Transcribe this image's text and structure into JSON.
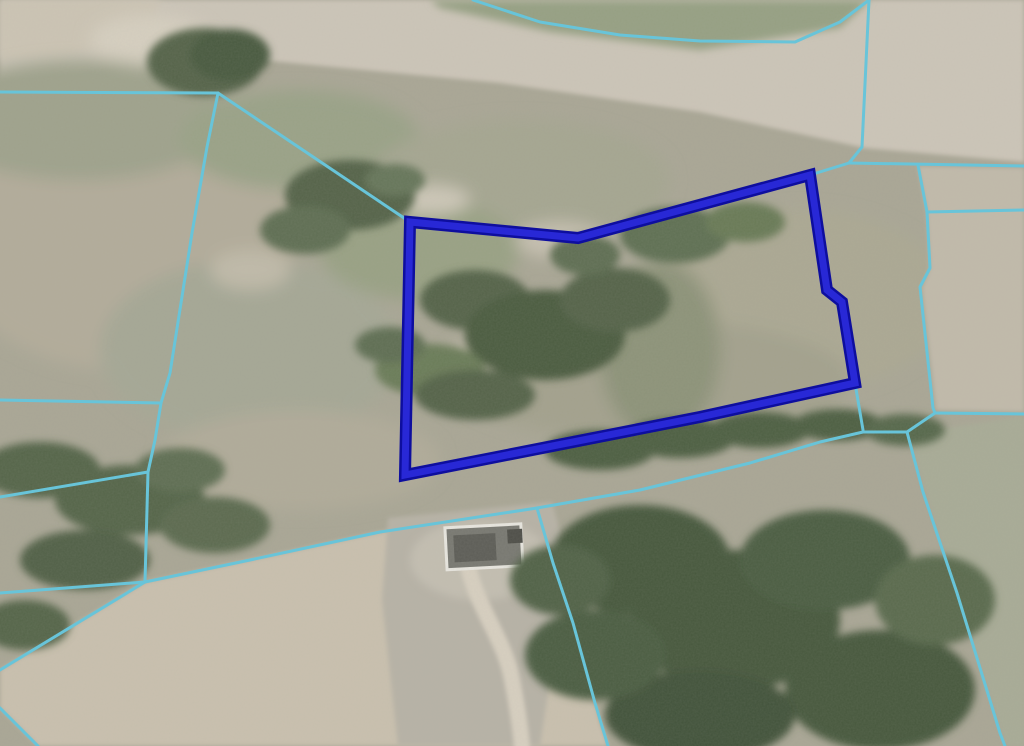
{
  "map": {
    "kind": "aerial-parcel-map",
    "palette": {
      "field_base": "#a9a695",
      "road": "#ccc5b8",
      "dirt_tan": "#c9c0ae",
      "concrete_pad": "#b7b2a6",
      "tree_dark": "#47583d",
      "tree_mid": "#54644a",
      "tree_light": "#6b7b59",
      "right_field_tan": "#c1baaa",
      "bottom_right_field": "#a8ab96",
      "driveway": "#d7cfc0"
    },
    "selected_parcel": {
      "label": "selected-parcel",
      "outline_color": "#2828d6",
      "outline_rim_color": "#0e0e9e",
      "outline_width": 7,
      "rim_width": 12,
      "points": [
        [
          410,
          222
        ],
        [
          578,
          238
        ],
        [
          810,
          175
        ],
        [
          827,
          290
        ],
        [
          842,
          302
        ],
        [
          855,
          383
        ],
        [
          700,
          417
        ],
        [
          405,
          475
        ]
      ]
    },
    "boundary_lines": {
      "color": "#68c4d9",
      "width": 3,
      "polylines": [
        [
          [
            0,
            92
          ],
          [
            218,
            93
          ]
        ],
        [
          [
            218,
            93
          ],
          [
            410,
            222
          ]
        ],
        [
          [
            218,
            93
          ],
          [
            207,
            147
          ],
          [
            192,
            233
          ],
          [
            170,
            373
          ],
          [
            161,
            403
          ],
          [
            155,
            440
          ],
          [
            148,
            472
          ],
          [
            145,
            582
          ]
        ],
        [
          [
            0,
            400
          ],
          [
            161,
            403
          ]
        ],
        [
          [
            0,
            497
          ],
          [
            148,
            472
          ]
        ],
        [
          [
            0,
            593
          ],
          [
            145,
            582
          ]
        ],
        [
          [
            145,
            582
          ],
          [
            0,
            670
          ]
        ],
        [
          [
            145,
            582
          ],
          [
            250,
            560
          ],
          [
            380,
            532
          ],
          [
            537,
            508
          ],
          [
            640,
            490
          ],
          [
            750,
            463
          ],
          [
            820,
            442
          ],
          [
            863,
            432
          ],
          [
            907,
            432
          ]
        ],
        [
          [
            537,
            508
          ],
          [
            553,
            563
          ],
          [
            573,
            623
          ],
          [
            595,
            703
          ],
          [
            608,
            746
          ]
        ],
        [
          [
            0,
            708
          ],
          [
            38,
            746
          ]
        ],
        [
          [
            473,
            0
          ],
          [
            540,
            22
          ],
          [
            620,
            35
          ],
          [
            700,
            41
          ],
          [
            795,
            42
          ],
          [
            840,
            22
          ],
          [
            869,
            0
          ]
        ],
        [
          [
            869,
            0
          ],
          [
            862,
            147
          ],
          [
            849,
            163
          ]
        ],
        [
          [
            849,
            163
          ],
          [
            810,
            175
          ]
        ],
        [
          [
            849,
            163
          ],
          [
            1024,
            166
          ]
        ],
        [
          [
            918,
            165
          ],
          [
            927,
            212
          ],
          [
            930,
            268
          ],
          [
            920,
            287
          ],
          [
            933,
            408
          ],
          [
            935,
            413
          ]
        ],
        [
          [
            927,
            212
          ],
          [
            1024,
            210
          ]
        ],
        [
          [
            935,
            413
          ],
          [
            1024,
            414
          ]
        ],
        [
          [
            935,
            413
          ],
          [
            907,
            432
          ]
        ],
        [
          [
            907,
            432
          ],
          [
            923,
            492
          ],
          [
            957,
            593
          ],
          [
            1000,
            733
          ],
          [
            1005,
            746
          ]
        ],
        [
          [
            855,
            383
          ],
          [
            863,
            430
          ]
        ]
      ]
    }
  }
}
